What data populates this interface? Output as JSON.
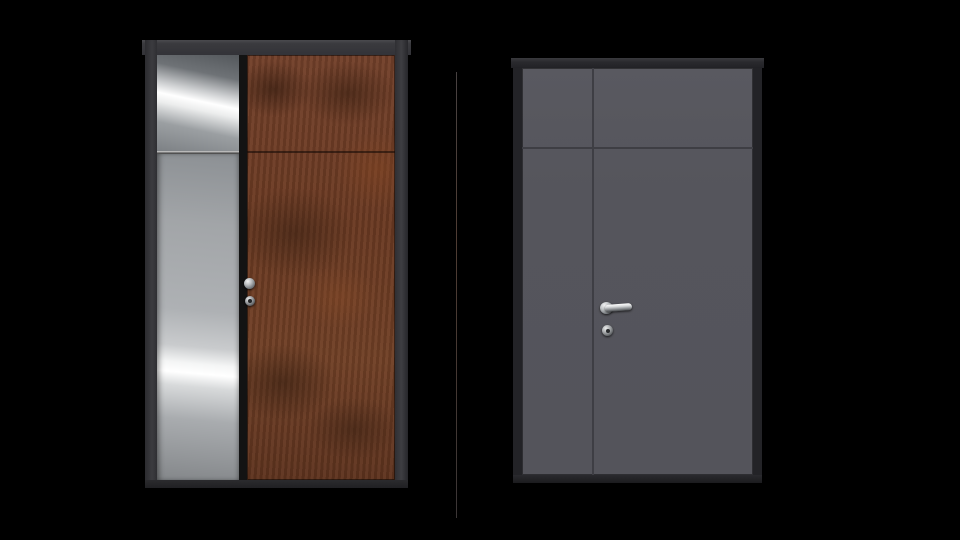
{
  "scene": {
    "background_color": "#000000",
    "divider_line": {
      "color_top": "#474141",
      "color_middle": "#4e3c33",
      "color_bottom": "#3b3636"
    },
    "doors": [
      {
        "id": "door-left",
        "style": "entrance door with stainless sidelite and rust steel leaf",
        "frame_color": "#38383c",
        "panels": [
          {
            "id": "sidelite-stainless",
            "material": "polished-stainless-steel",
            "base_color": "#a2a5a8",
            "highlight_color": "#ffffff",
            "shadow_color": "#54585c",
            "horizontal_seam_position_ratio": 0.226
          },
          {
            "id": "leaf-corten",
            "material": "corten-rust-steel",
            "base_color": "#6e3a21",
            "dark_mottle_color": "#301a0d",
            "light_mottle_color": "#8a4c2a",
            "horizontal_seam_position_ratio": 0.226
          }
        ],
        "hardware": [
          {
            "id": "knob",
            "finish": "chrome"
          },
          {
            "id": "lock-cylinder",
            "finish": "chrome"
          }
        ]
      },
      {
        "id": "door-right",
        "style": "anthracite double door with transom panels",
        "frame_color": "#232327",
        "leaf_color": "#55555c",
        "seam_color": "#3e3e44",
        "layout": {
          "vertical_seam_position_ratio": 0.3,
          "horizontal_seam_position_ratio": 0.195
        },
        "hardware": [
          {
            "id": "lever-handle",
            "finish": "chrome"
          },
          {
            "id": "lock-cylinder",
            "finish": "chrome"
          }
        ]
      }
    ]
  }
}
